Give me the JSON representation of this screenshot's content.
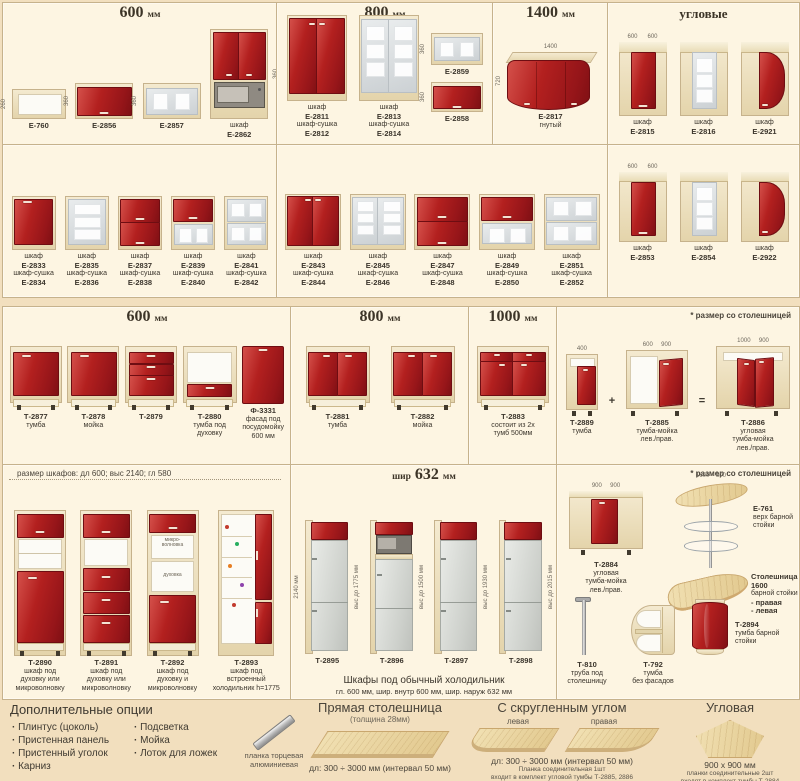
{
  "colors": {
    "page": "#f2dfbe",
    "panel": "#fdf5e2",
    "red": "#b3201f",
    "carc1": "#f4ead0",
    "carc2": "#e4d4ab",
    "border": "#c6b28c",
    "glass1": "#e9eced",
    "glass2": "#ccd1d4",
    "wood1": "#f1e0b2",
    "wood2": "#e2c98f"
  },
  "panels": [
    {
      "id": "wall-600",
      "x": 2,
      "y": 2,
      "w": 274,
      "h": 142,
      "hd": "600 мм",
      "hs": "big",
      "rt": 24,
      "rb": 5,
      "lh": 18,
      "items": [
        {
          "c": [
            "Е-760"
          ],
          "a": "openbox",
          "w": 54,
          "h": 30,
          "dl": "260"
        },
        {
          "c": [
            "Е-2856"
          ],
          "a": "flip_red",
          "w": 58,
          "h": 36,
          "dl": "360"
        },
        {
          "c": [
            "Е-2857"
          ],
          "a": "flip_glass",
          "w": 58,
          "h": 36,
          "dl": "360"
        },
        {
          "c": [
            "шкаф",
            "Е-2862"
          ],
          "a": "micro_tall",
          "w": 58,
          "h": 90,
          "dr": "360"
        }
      ]
    },
    {
      "id": "wall-800",
      "x": 276,
      "y": 2,
      "w": 216,
      "h": 142,
      "hd": "800 мм",
      "hs": "big",
      "rt": 24,
      "rb": 5,
      "lh": 36,
      "items": [
        {
          "c": [
            "шкаф",
            "Е-2811",
            "шкаф-сушка",
            "Е-2812"
          ],
          "a": "wall2_red",
          "w": 60,
          "h": 86
        },
        {
          "c": [
            "шкаф",
            "Е-2813",
            "шкаф-сушка",
            "Е-2814"
          ],
          "a": "wall2_glass",
          "w": 60,
          "h": 86
        },
        {
          "mb": 16,
          "stack": [
            {
              "c": [
                "Е-2859"
              ],
              "a": "flip_glass",
              "w": 52,
              "h": 32,
              "dl": "360"
            },
            {
              "c": [
                "Е-2858"
              ],
              "a": "flip_red",
              "w": 52,
              "h": 30,
              "dl": "360"
            }
          ]
        }
      ]
    },
    {
      "id": "wall-1400",
      "x": 492,
      "y": 2,
      "w": 115,
      "h": 142,
      "hd": "1400 мм",
      "hs": "big",
      "rt": 24,
      "rb": 14,
      "lh": 18,
      "items": [
        {
          "c": [
            "Е-2817",
            "гнутый"
          ],
          "a": "curved",
          "w": 88,
          "h": 58,
          "dt": "1400",
          "dl": "720"
        }
      ]
    },
    {
      "id": "wall-corner",
      "x": 607,
      "y": 2,
      "w": 191,
      "h": 142,
      "hd": "угловые",
      "hs": "mid",
      "rt": 20,
      "rb": 8,
      "lh": 18,
      "items": [
        {
          "c": [
            "шкаф",
            "Е-2815"
          ],
          "a": "corner_red",
          "w": 48,
          "h": 74,
          "dt": "600      600"
        },
        {
          "c": [
            "шкаф",
            "Е-2816"
          ],
          "a": "corner_glass",
          "w": 48,
          "h": 74
        },
        {
          "c": [
            "шкаф",
            "Е-2921"
          ],
          "a": "corner_curve",
          "w": 48,
          "h": 74
        }
      ]
    },
    {
      "id": "wall-600-row2",
      "x": 2,
      "y": 144,
      "w": 274,
      "h": 152,
      "rt": 14,
      "rb": 8,
      "lh": 36,
      "items": [
        {
          "c": [
            "шкаф",
            "Е-2833",
            "шкаф-сушка",
            "Е-2834"
          ],
          "a": "wall1_red",
          "w": 44,
          "h": 54
        },
        {
          "c": [
            "шкаф",
            "Е-2835",
            "шкаф-сушка",
            "Е-2836"
          ],
          "a": "wall1_glass",
          "w": 44,
          "h": 54
        },
        {
          "c": [
            "шкаф",
            "Е-2837",
            "шкаф-сушка",
            "Е-2838"
          ],
          "a": "flip2_red",
          "w": 44,
          "h": 54
        },
        {
          "c": [
            "шкаф",
            "Е-2839",
            "шкаф-сушка",
            "Е-2840"
          ],
          "a": "flip_red_glass",
          "w": 44,
          "h": 54
        },
        {
          "c": [
            "шкаф",
            "Е-2841",
            "шкаф-сушка",
            "Е-2842"
          ],
          "a": "flip2_glass",
          "w": 44,
          "h": 54
        }
      ]
    },
    {
      "id": "wall-800-row2",
      "x": 276,
      "y": 144,
      "w": 331,
      "h": 152,
      "rt": 14,
      "rb": 8,
      "lh": 36,
      "items": [
        {
          "c": [
            "шкаф",
            "Е-2843",
            "шкаф-сушка",
            "Е-2844"
          ],
          "a": "wall2_red",
          "w": 56,
          "h": 56
        },
        {
          "c": [
            "шкаф",
            "Е-2845",
            "шкаф-сушка",
            "Е-2846"
          ],
          "a": "wall2_glass",
          "w": 56,
          "h": 56
        },
        {
          "c": [
            "шкаф",
            "Е-2847",
            "шкаф-сушка",
            "Е-2848"
          ],
          "a": "flip2_red",
          "w": 56,
          "h": 56
        },
        {
          "c": [
            "шкаф",
            "Е-2849",
            "шкаф-сушка",
            "Е-2850"
          ],
          "a": "flip_red_glass",
          "w": 56,
          "h": 56
        },
        {
          "c": [
            "шкаф",
            "Е-2851",
            "шкаф-сушка",
            "Е-2852"
          ],
          "a": "flip2_glass",
          "w": 56,
          "h": 56
        }
      ]
    },
    {
      "id": "corner-row2",
      "x": 607,
      "y": 144,
      "w": 191,
      "h": 152,
      "rt": 14,
      "rb": 34,
      "lh": 18,
      "items": [
        {
          "c": [
            "шкаф",
            "Е-2853"
          ],
          "a": "corner_red",
          "w": 48,
          "h": 70,
          "dt": "600      600"
        },
        {
          "c": [
            "шкаф",
            "Е-2854"
          ],
          "a": "corner_glass",
          "w": 48,
          "h": 70
        },
        {
          "c": [
            "шкаф",
            "Е-2922"
          ],
          "a": "corner_curve",
          "w": 48,
          "h": 70
        }
      ]
    },
    {
      "id": "base-600",
      "x": 2,
      "y": 306,
      "w": 288,
      "h": 158,
      "hd": "600 мм",
      "hs": "big",
      "rt": 24,
      "rb": 24,
      "lh": 28,
      "items": [
        {
          "c": [
            "Т-2877",
            "тумба"
          ],
          "a": "base_door",
          "w": 52,
          "h": 64
        },
        {
          "c": [
            "Т-2878",
            "мойка"
          ],
          "a": "base_door",
          "w": 52,
          "h": 64
        },
        {
          "c": [
            "Т-2879"
          ],
          "a": "base_drw3",
          "w": 52,
          "h": 64
        },
        {
          "c": [
            "Т-2880",
            "тумба под",
            "духовку"
          ],
          "a": "base_oven",
          "w": 54,
          "h": 64
        },
        {
          "c": [
            "Ф-3331",
            "фасад под",
            "посудомойку",
            "600 мм"
          ],
          "a": "dish_front",
          "w": 42,
          "h": 58
        }
      ]
    },
    {
      "id": "base-800",
      "x": 290,
      "y": 306,
      "w": 178,
      "h": 158,
      "hd": "800 мм",
      "hs": "big",
      "rt": 24,
      "rb": 24,
      "lh": 28,
      "items": [
        {
          "c": [
            "Т-2881",
            "тумба"
          ],
          "a": "base2",
          "w": 64,
          "h": 64
        },
        {
          "c": [
            "Т-2882",
            "мойка"
          ],
          "a": "base2",
          "w": 64,
          "h": 64
        }
      ]
    },
    {
      "id": "base-1000",
      "x": 468,
      "y": 306,
      "w": 88,
      "h": 158,
      "hd": "1000 мм",
      "hs": "big",
      "rt": 24,
      "rb": 24,
      "lh": 28,
      "items": [
        {
          "c": [
            "Т-2883",
            "состоит из 2х",
            "тумб 500мм"
          ],
          "a": "base_1000",
          "w": 72,
          "h": 64
        }
      ]
    },
    {
      "id": "corner-base",
      "x": 556,
      "y": 306,
      "w": 242,
      "h": 158,
      "hd": "* размер со столешницей",
      "hs": "right",
      "rt": 18,
      "rb": 10,
      "lh": 36,
      "items": [
        {
          "c": [
            "Т-2889",
            "тумба"
          ],
          "a": "base_narrow",
          "w": 32,
          "h": 62,
          "dt": "400",
          "after": "+"
        },
        {
          "c": [
            "Т-2885",
            "тумба-мойка",
            "лев./прав."
          ],
          "a": "corner_open",
          "w": 62,
          "h": 66,
          "dt": "600     900",
          "after": "="
        },
        {
          "c": [
            "Т-2886",
            "угловая",
            "тумба-мойка",
            "лев./прав."
          ],
          "a": "corner_sink2",
          "w": 74,
          "h": 70,
          "dt": "1000     900"
        }
      ]
    },
    {
      "id": "tall-cabinets",
      "x": 2,
      "y": 464,
      "w": 288,
      "h": 234,
      "hd": "размер шкафов:  дл 600;  выс 2140;  гл 580",
      "hs": "left",
      "rt": 18,
      "rb": 4,
      "lh": 36,
      "items": [
        {
          "c": [
            "Т-2890",
            "шкаф под",
            "духовку или",
            "микроволновку"
          ],
          "a": "tall_a",
          "w": 52,
          "h": 146
        },
        {
          "c": [
            "Т-2891",
            "шкаф под",
            "духовку или",
            "микроволновку"
          ],
          "a": "tall_b",
          "w": 52,
          "h": 146
        },
        {
          "c": [
            "Т-2892",
            "шкаф под",
            "духовку и",
            "микроволновку"
          ],
          "a": "tall_c",
          "w": 52,
          "h": 146,
          "n1": "микро-\nволновка",
          "n2": "духовка"
        },
        {
          "c": [
            "Т-2893",
            "шкаф под",
            "встроенный",
            "холодильник h=1775"
          ],
          "a": "tall_fridge",
          "w": 56,
          "h": 146
        }
      ]
    },
    {
      "id": "fridge-cabinets",
      "x": 290,
      "y": 464,
      "w": 266,
      "h": 234,
      "hd": "шир 632 мм",
      "hs": "big",
      "rt": 24,
      "rb": 32,
      "lh": 10,
      "ft": [
        "Шкафы под обычный холодильник",
        "гл. 600 мм,    шир. внутр 600 мм,    шир. наруж 632 мм"
      ],
      "items": [
        {
          "c": [
            "Т-2895"
          ],
          "a": "fridge_a",
          "w": 44,
          "h": 134,
          "dl": "2140 мм",
          "dr": "выс до 1775 мм"
        },
        {
          "c": [
            "Т-2896"
          ],
          "a": "fridge_micro",
          "w": 44,
          "h": 134,
          "dr": "выс до 1500 мм"
        },
        {
          "c": [
            "Т-2897"
          ],
          "a": "fridge_a",
          "w": 44,
          "h": 134,
          "dr": "выс до 1930 мм"
        },
        {
          "c": [
            "Т-2898"
          ],
          "a": "fridge_a",
          "w": 44,
          "h": 134,
          "dr": "выс до 2015 мм"
        }
      ]
    },
    {
      "id": "bar-corner",
      "x": 556,
      "y": 464,
      "w": 242,
      "h": 234,
      "hd": "* размер со столешницей",
      "hs": "right",
      "abs": true,
      "items": [
        {
          "c": [
            "Т-2884",
            "угловая",
            "тумба-мойка",
            "лев./прав."
          ],
          "a": "corner_sink1",
          "w": 74,
          "h": 64,
          "ax": 12,
          "ay": 26,
          "dt": "900     900",
          "lx": 8,
          "ly": 96,
          "lw": 82,
          "la": "center"
        },
        {
          "c": [
            "Е-761",
            "верх барной",
            "стойки"
          ],
          "a": "bar_top",
          "w": 76,
          "h": 88,
          "ax": 116,
          "ay": 16,
          "dt": "1600    500",
          "lx": 196,
          "ly": 40,
          "lw": 44,
          "la": "left"
        },
        {
          "c": [
            "Столешница 1600",
            "барной стойки",
            "- правая",
            "- левая"
          ],
          "a": "counter_oval",
          "w": 82,
          "h": 34,
          "ax": 110,
          "ay": 112,
          "lx": 194,
          "ly": 108,
          "lw": 48,
          "la": "left"
        },
        {
          "c": [
            "Т-810",
            "труба под",
            "столешницу"
          ],
          "a": "pole",
          "w": 20,
          "h": 58,
          "ax": 16,
          "ay": 132,
          "lx": 2,
          "ly": 196,
          "lw": 56,
          "la": "center"
        },
        {
          "c": [
            "Т-792",
            "тумба",
            "без фасадов"
          ],
          "a": "shelf_open",
          "w": 44,
          "h": 50,
          "ax": 74,
          "ay": 140,
          "lx": 66,
          "ly": 196,
          "lw": 60,
          "la": "center"
        },
        {
          "c": [
            "Т-2894",
            "тумба барной",
            "стойки"
          ],
          "a": "bar_base",
          "w": 38,
          "h": 56,
          "ax": 134,
          "ay": 134,
          "lx": 178,
          "ly": 156,
          "lw": 62,
          "la": "left"
        }
      ]
    }
  ],
  "bottom": {
    "extras": {
      "title": "Дополнительные опции",
      "col1": [
        "Плинтус (цоколь)",
        "Пристенная панель",
        "Пристенный уголок",
        "Карниз"
      ],
      "col2": [
        "Подсветка",
        "Мойка",
        "Лоток для ложек"
      ],
      "strip_caption": "планка торцевая алюминиевая"
    },
    "straight": {
      "title": "Прямая столешница",
      "subtitle": "(толщина 28мм)",
      "range": "дл: 300 ÷ 3000 мм (интервал 50 мм)"
    },
    "rounded": {
      "title": "С скругленным углом",
      "left_label": "левая",
      "right_label": "правая",
      "range": "дл: 300 ÷ 3000 мм (интервал 50 мм)",
      "note1": "Планка соединительная 1шт",
      "note2": "входит в комплект угловой тумбы Т-2885, 2886"
    },
    "corner": {
      "title": "Угловая",
      "size": "900 х 900 мм",
      "note1": "планки соединительные 2шт",
      "note2": "входят в комплект тумбы Т-2884"
    }
  }
}
